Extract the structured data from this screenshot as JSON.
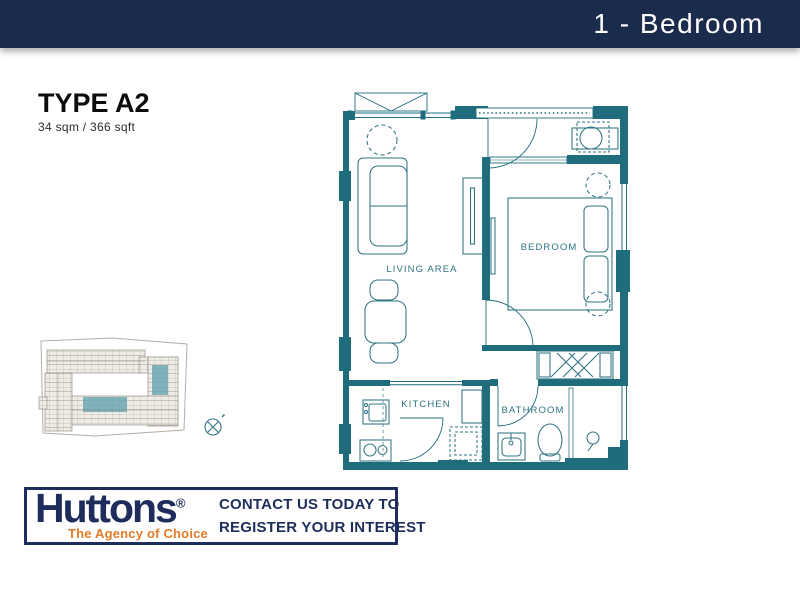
{
  "header": {
    "title": "1 - Bedroom"
  },
  "unit": {
    "type": "TYPE A2",
    "area": "34 sqm / 366 sqft"
  },
  "floorplan": {
    "labels": {
      "living": "LIVING AREA",
      "bedroom": "BEDROOM",
      "kitchen": "KITCHEN",
      "bathroom": "BATHROOM"
    },
    "wall_color": "#1e6c7c"
  },
  "siteplan": {
    "highlight_color": "#6da8b2",
    "outline_color": "#b5aea6",
    "compass": "compass-north-icon"
  },
  "footer": {
    "brand": "Huttons",
    "registered": "®",
    "tagline": "The Agency of Choice",
    "cta_line1": "CONTACT US TODAY TO",
    "cta_line2": "REGISTER YOUR INTEREST",
    "navy": "#1f2d5c",
    "orange": "#e07c28"
  }
}
